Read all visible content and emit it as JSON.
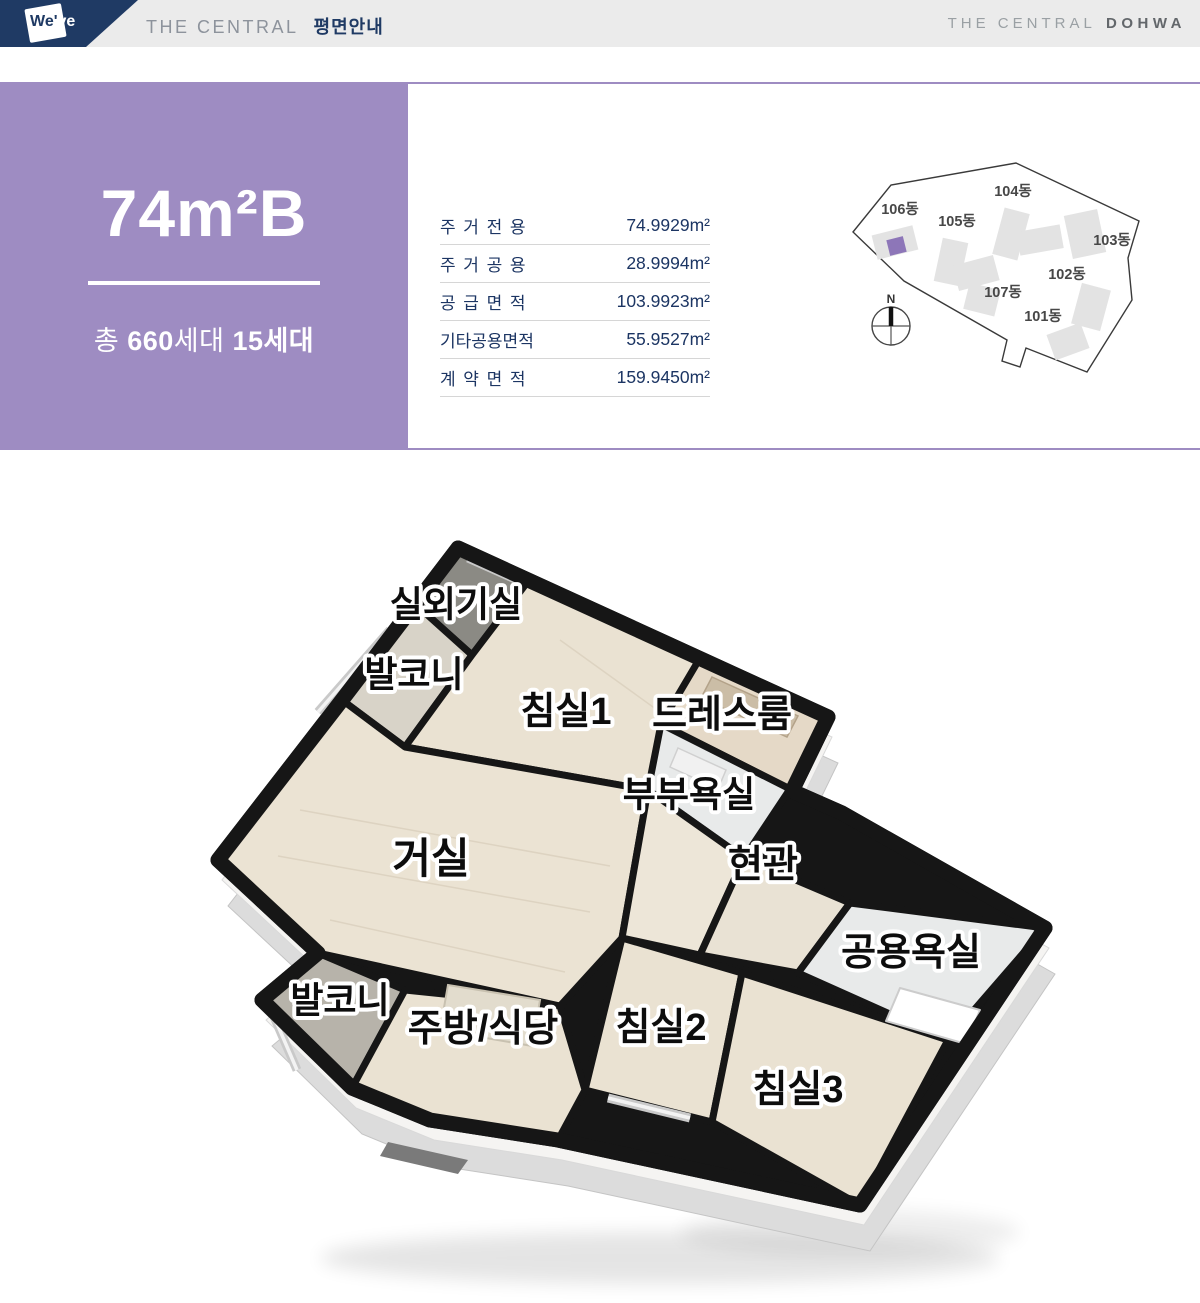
{
  "header": {
    "logo": "We've",
    "logo_part1": "We'",
    "logo_part2": "ve",
    "brand_left_en": "THE CENTRAL",
    "brand_left_ko": "평면안내",
    "brand_right_en": "THE CENTRAL",
    "brand_right_bold": "DOHWA"
  },
  "unit": {
    "name": "74m²B",
    "count_prefix": "총 ",
    "total_bold": "660",
    "total_suffix": "세대 ",
    "type_count": "15세대"
  },
  "area_table": {
    "rows": [
      {
        "label": "주거전용",
        "value": "74.9929m²",
        "spread": true
      },
      {
        "label": "주거공용",
        "value": "28.9994m²",
        "spread": true
      },
      {
        "label": "공급면적",
        "value": "103.9923m²",
        "spread": true
      },
      {
        "label": "기타공용면적",
        "value": "55.9527m²",
        "spread": false
      },
      {
        "label": "계약면적",
        "value": "159.9450m²",
        "spread": true
      }
    ]
  },
  "site_map": {
    "compass_label": "N",
    "highlight_color": "#8d76b8",
    "building_fill": "#e3e3e3",
    "buildings": [
      {
        "name": "101동",
        "lx": 193,
        "ly": 171,
        "parts": [
          [
            200,
            178,
            36,
            27,
            -20
          ]
        ],
        "highlight": false
      },
      {
        "name": "102동",
        "lx": 217,
        "ly": 129,
        "parts": [
          [
            226,
            136,
            30,
            42,
            15
          ]
        ],
        "highlight": false
      },
      {
        "name": "103동",
        "lx": 262,
        "ly": 95,
        "parts": [
          [
            218,
            62,
            34,
            44,
            -12
          ]
        ],
        "highlight": false
      },
      {
        "name": "104동",
        "lx": 163,
        "ly": 46,
        "parts": [
          [
            148,
            60,
            26,
            48,
            15
          ],
          [
            168,
            78,
            44,
            24,
            -10
          ]
        ],
        "highlight": false
      },
      {
        "name": "105동",
        "lx": 107,
        "ly": 76,
        "parts": [
          [
            88,
            90,
            26,
            44,
            12
          ],
          [
            105,
            110,
            42,
            26,
            -15
          ]
        ],
        "highlight": false
      },
      {
        "name": "106동",
        "lx": 50,
        "ly": 64,
        "parts": [
          [
            24,
            80,
            42,
            25,
            -14
          ]
        ],
        "highlight": true,
        "unit": [
          38,
          88,
          17,
          16,
          -14
        ]
      },
      {
        "name": "107동",
        "lx": 153,
        "ly": 147,
        "parts": [
          [
            116,
            136,
            32,
            27,
            14
          ]
        ],
        "highlight": false
      }
    ]
  },
  "floor_plan": {
    "rooms": [
      {
        "label": "실외기실",
        "x": 456,
        "y": 607,
        "size": 36
      },
      {
        "label": "발코니",
        "x": 414,
        "y": 677,
        "size": 36
      },
      {
        "label": "침실1",
        "x": 566,
        "y": 714,
        "size": 38
      },
      {
        "label": "드레스룸",
        "x": 722,
        "y": 717,
        "size": 38
      },
      {
        "label": "부부욕실",
        "x": 689,
        "y": 797,
        "size": 36
      },
      {
        "label": "거실",
        "x": 431,
        "y": 862,
        "size": 42
      },
      {
        "label": "현관",
        "x": 763,
        "y": 867,
        "size": 38
      },
      {
        "label": "공용욕실",
        "x": 911,
        "y": 955,
        "size": 38
      },
      {
        "label": "발코니",
        "x": 340,
        "y": 1003,
        "size": 36
      },
      {
        "label": "주방/식당",
        "x": 483,
        "y": 1031,
        "size": 38
      },
      {
        "label": "침실2",
        "x": 661,
        "y": 1030,
        "size": 38
      },
      {
        "label": "침실3",
        "x": 798,
        "y": 1092,
        "size": 38
      }
    ]
  },
  "colors": {
    "navy": "#1f3a64",
    "purple": "#9e8cc2",
    "table_text": "#1c3563",
    "header_bg": "#ebebeb",
    "wall_black": "#161616",
    "floor_wood": "#eae2d2"
  }
}
